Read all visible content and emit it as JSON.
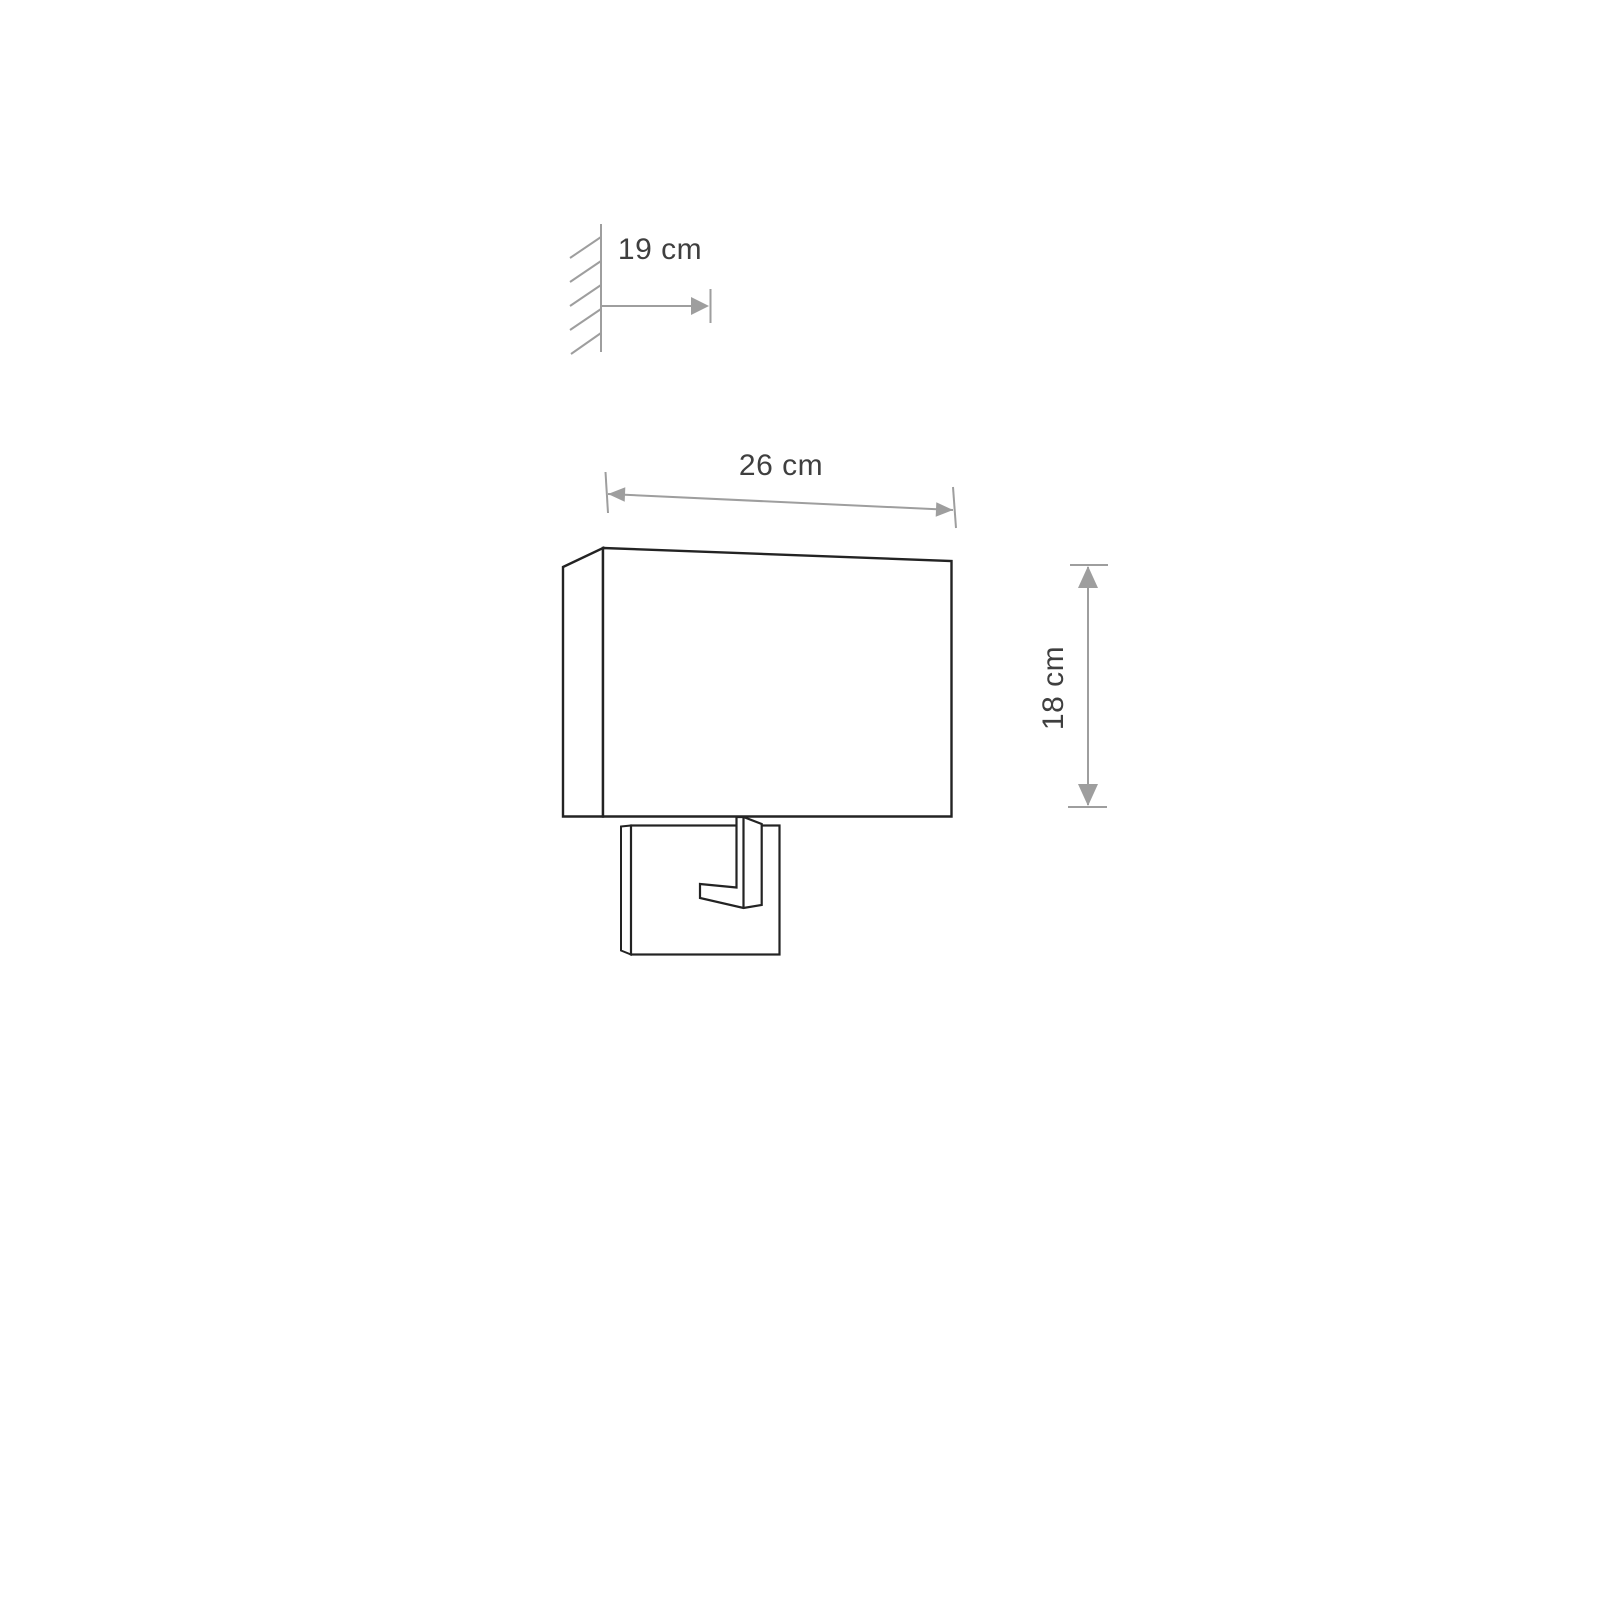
{
  "canvas": {
    "background": "#ffffff"
  },
  "drawing": {
    "kind": "wall-lamp-dimension-diagram",
    "labels": {
      "depth": "19 cm",
      "width": "26 cm",
      "height": "18 cm"
    },
    "values": {
      "depth_cm": 19,
      "width_cm": 26,
      "height_cm": 18,
      "unit": "cm"
    },
    "colors": {
      "dimension": "#9e9e9e",
      "outline": "#232323",
      "text": "#3f3f3f",
      "background": "#ffffff"
    }
  }
}
